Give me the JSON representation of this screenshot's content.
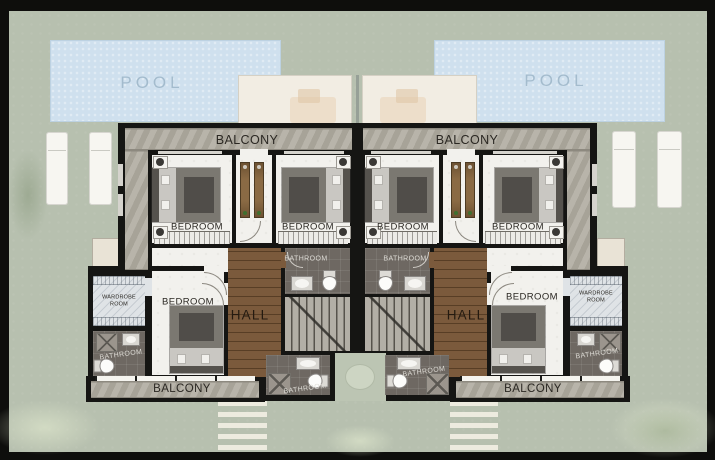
{
  "meta": {
    "description": "First-floor architectural plan of two mirrored twin villas with pools"
  },
  "labels": {
    "pool": "POOL",
    "balcony": "BALCONY",
    "bedroom": "BEDROOM",
    "bathroom": "BATHROOM",
    "hall": "HALL",
    "wardrobe": "WARDROBE",
    "room": "ROOM"
  },
  "colors": {
    "lawn": "#b7c0af",
    "pool": "#cfe0ee",
    "pool_ink": "#9fb8ca",
    "wall": "#151513",
    "balcony": "#b1ada2",
    "floor": "#f2f1ed",
    "bathroom": "#6e6862",
    "wood": "#7b5a3c",
    "stairs": "#b3afa6",
    "wardrobe": "#dfe3e6",
    "panel": "#f2ede3",
    "walkway": "#edebdf",
    "ink": "#2b2823"
  }
}
